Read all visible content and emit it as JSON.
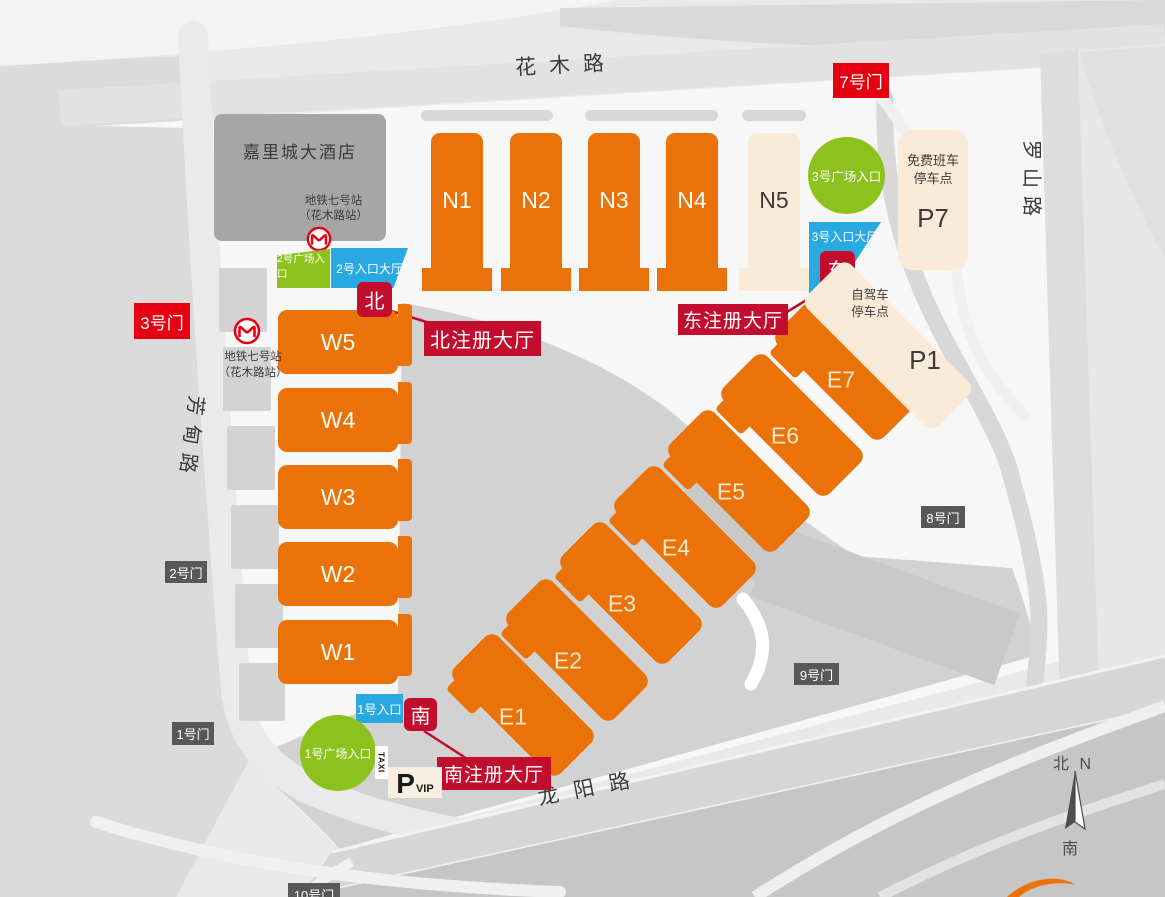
{
  "roads": {
    "huamu": "花木路",
    "luoshan": "罗山路",
    "fangdian": "芳甸路",
    "longyang": "龙阳路"
  },
  "hotel": {
    "name": "嘉里城大酒店",
    "metro_line1": "地铁七号站",
    "metro_line2": "（花木路站）"
  },
  "metro_west": {
    "line1": "地铁七号站",
    "line2": "（花木路站）"
  },
  "gates": {
    "g1": "1号门",
    "g2": "2号门",
    "g3": "3号门",
    "g7": "7号门",
    "g8": "8号门",
    "g9": "9号门",
    "g10": "10号门"
  },
  "halls": {
    "north": [
      "N1",
      "N2",
      "N3",
      "N4"
    ],
    "n5": "N5",
    "west": [
      "W5",
      "W4",
      "W3",
      "W2",
      "W1"
    ],
    "east": [
      "E1",
      "E2",
      "E3",
      "E4",
      "E5",
      "E6",
      "E7"
    ]
  },
  "entrances": {
    "plaza1": "1号广场入口",
    "plaza2": "2号广场入口",
    "plaza3": "3号广场入口",
    "gate1": "1号入口",
    "hall2": "2号入口大厅",
    "hall3": "3号入口大厅"
  },
  "registration": {
    "north_badge": "北",
    "north": "北注册大厅",
    "east_badge": "东",
    "east": "东注册大厅",
    "south_badge": "南",
    "south": "南注册大厅"
  },
  "parking": {
    "p7": "P7",
    "p7_note1": "免费班车",
    "p7_note2": "停车点",
    "p1": "P1",
    "p1_note1": "自驾车",
    "p1_note2": "停车点",
    "taxi": "TAXI",
    "vip_p": "P",
    "vip": "VIP"
  },
  "compass": {
    "north": "北 N",
    "south": "南"
  },
  "colors": {
    "hall_orange": "#EB7208",
    "entrance_green": "#8DC21E",
    "entrance_blue": "#29A9E1",
    "gate_red": "#E60012",
    "registration_crimson": "#C30D2E",
    "parking_cream": "#FAEBD9",
    "gate_gray": "#595757"
  }
}
